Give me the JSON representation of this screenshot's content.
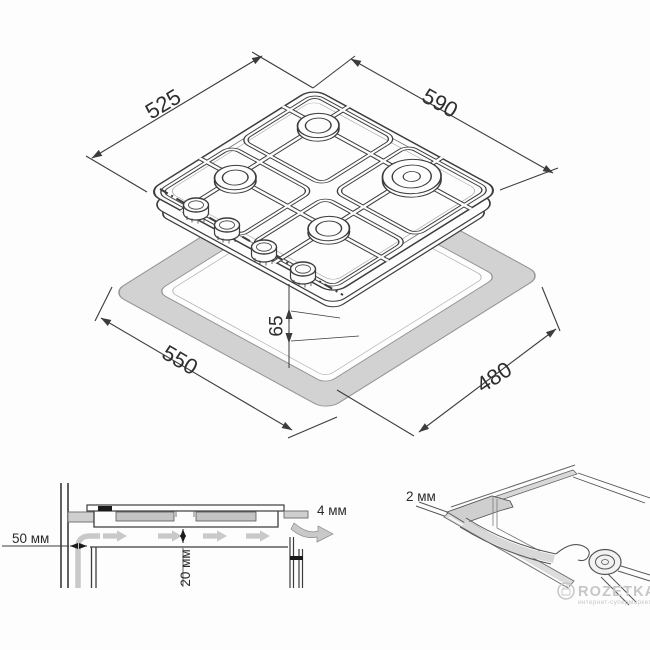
{
  "colors": {
    "line": "#3c3c3c",
    "band_fill": "#d2d2d2",
    "band_stroke": "#949494",
    "flow_gray": "#c9c9c9",
    "section_gray": "#cfcfcf",
    "watermark_gray": "#c6c6c6",
    "background": "#fdfdfd"
  },
  "iso_view": {
    "hob_width_label": "525",
    "hob_depth_label": "590",
    "cutout_width_label": "550",
    "cutout_depth_label": "480",
    "drop_height_label": "65"
  },
  "section_view": {
    "wall_clearance_label": "50 мм",
    "bottom_clearance_label": "20 мм",
    "rear_vent_label": "4 мм"
  },
  "seal_detail": {
    "seal_thickness_label": "2 мм"
  },
  "watermark": {
    "brand": "ROZETKA",
    "tagline": "интернет-супермаркет"
  }
}
